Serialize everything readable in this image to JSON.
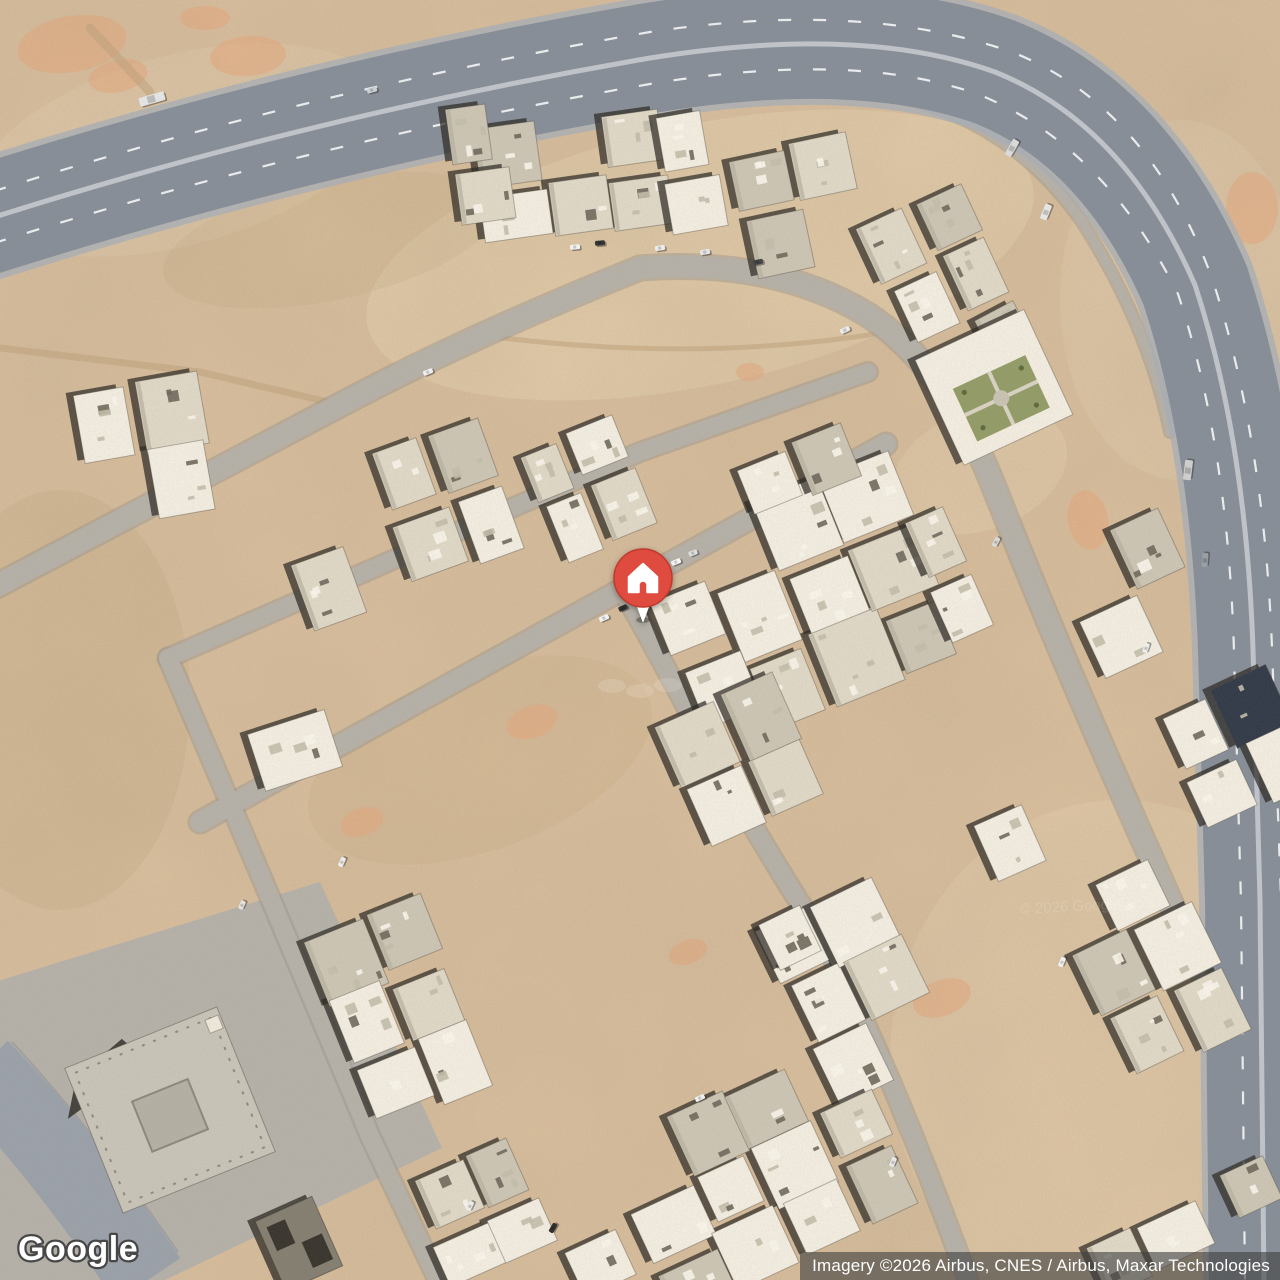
{
  "map": {
    "view_type": "satellite",
    "logo_text": "Google",
    "attribution_text": "Imagery ©2026 Airbus, CNES / Airbus, Maxar Technologies",
    "watermark_text": "© 2026 Google",
    "marker": {
      "icon": "home",
      "x": 643,
      "y": 578,
      "color": "#DF4B3E",
      "rim_color": "#c0392e",
      "glyph_color": "#ffffff",
      "stem_color": "#ffffff"
    },
    "palette": {
      "desert_base": "#d7bd9c",
      "desert_dark": "#c0a37c",
      "desert_light": "#e6d2b2",
      "desert_pink": "#e8a87c",
      "street": "#b6b1a8",
      "street_edge": "#9d978d",
      "highway": "#878e98",
      "highway_edge": "#a9afb7",
      "highway_median": "#c1c5cb",
      "lane_marking": "#ffffff",
      "plaza": "#b5b1a9",
      "arterial": "#9ba1a9",
      "building_light": "#f2ede0",
      "building_mid": "#e0d8c6",
      "building_gray": "#ccc5b4",
      "building_dark_roof": "#333b49",
      "building_concrete": "#c9c4b8",
      "building_shadow": "#2b2823",
      "courtyard_green": "#939c68",
      "attribution_bg": "rgba(64,64,64,0.62)",
      "attribution_text_color": "#ffffff",
      "logo_fill": "#ffffff",
      "logo_outline": "#474747"
    }
  }
}
